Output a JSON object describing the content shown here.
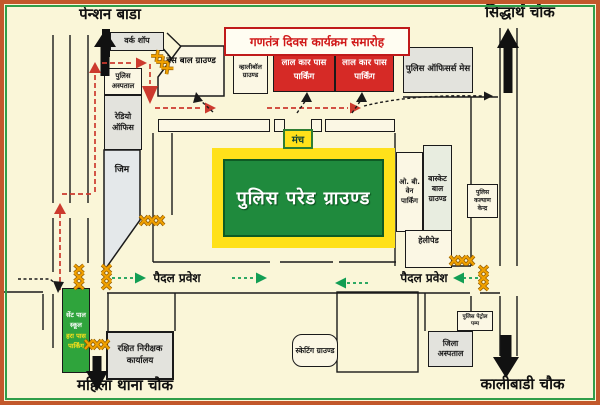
{
  "title": "गणतंत्र दिवस कार्यक्रम समारोह",
  "landmarks": {
    "pension_bada": "पेन्शन बाडा",
    "siddharth_chowk": "सिद्धार्थ चौक",
    "mahila_thana_chowk": "महिला थाना चौक",
    "kalibadi_chowk": "कालीबाडी चौक"
  },
  "grounds": {
    "parade": "पुलिस परेड ग्राउण्ड",
    "stage": "मंच",
    "baseball": "बेस बाल ग्राउण्ड",
    "volleyball": "व्हालीबॉल ग्राउण्ड",
    "basketball": "बास्केट बाल ग्राउण्ड",
    "skating": "स्केटिंग ग्राउण्ड",
    "helipad": "हेलीपेड"
  },
  "buildings": {
    "work_shop": "वर्क शॉप",
    "police_hospital": "पुलिस अस्पताल",
    "radio_office": "रेडियो ऑफिस",
    "gym": "जिम",
    "officers_mess": "पुलिस ऑफिसर्स मेस",
    "welfare_center": "पुलिस कल्याण केन्द्र",
    "rakshit_office": "रक्षित निरीक्षक कार्यालय",
    "district_hospital": "जिला अस्पताल",
    "petrol_pump": "पुलिस पेट्रोल पम्प"
  },
  "parking": {
    "red_pass_1": "लाल कार पास पार्किंग",
    "red_pass_2": "लाल कार पास पार्किंग",
    "ob_van": "ओ. बी. वेन पार्किंग",
    "green_pass_school": "सेंट पाल स्कूल",
    "green_pass_label": "हरा पास पार्किंग"
  },
  "entrances": {
    "pedestrian_left": "पैदल प्रवेश",
    "pedestrian_right": "पैदल प्रवेश"
  },
  "colors": {
    "background": "#FAF6D8",
    "frame_saffron": "#C2582B",
    "frame_green": "#2F9E49",
    "red_parking": "#D62A26",
    "green_parking": "#2FA43C",
    "parade_green": "#1F8A3D",
    "parade_yellow": "#FFE11A",
    "title_red": "#D01818",
    "barricade_orange": "#F0A000",
    "route_red": "#CC3A2E",
    "pedestrian_green": "#129E54"
  }
}
